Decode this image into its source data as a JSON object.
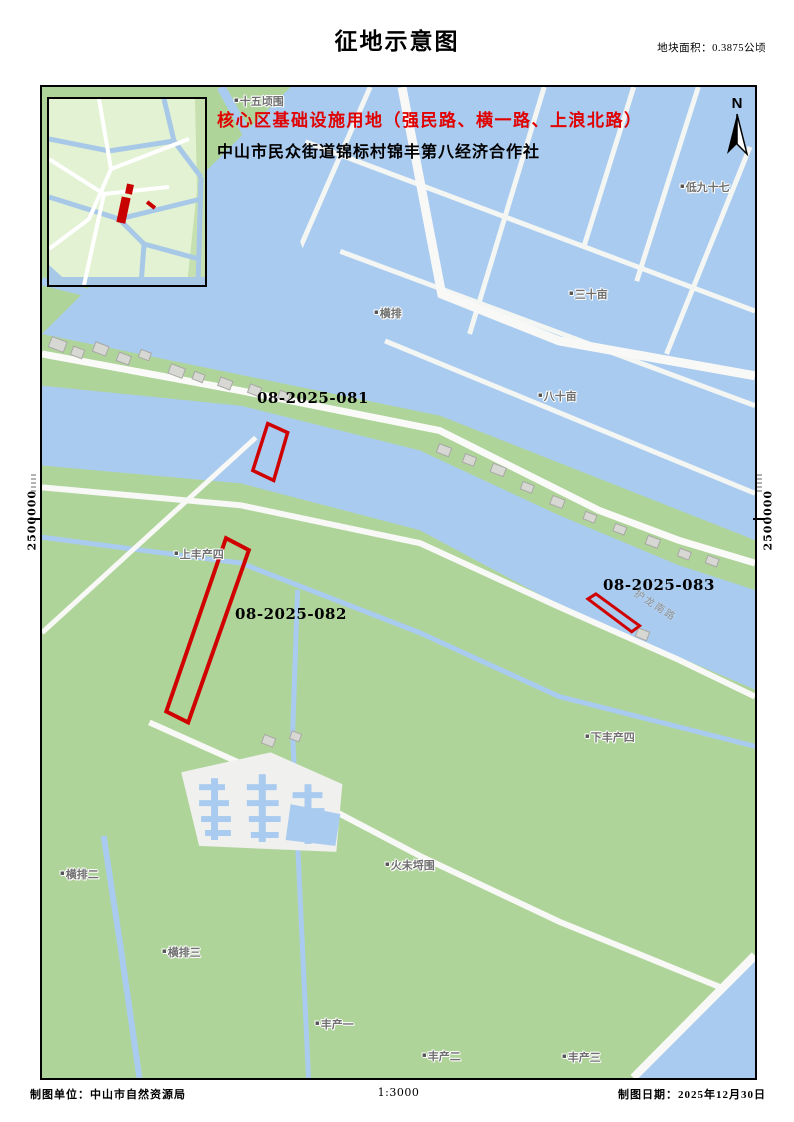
{
  "title": "征地示意图",
  "area_note": "地块面积：0.3875公顷",
  "header": {
    "line1": "核心区基础设施用地（强民路、横一路、上浪北路）",
    "line2": "中山市民众街道锦标村锦丰第八经济合作社"
  },
  "north": {
    "label": "N"
  },
  "axis": {
    "left": "2500000",
    "right": "2500000"
  },
  "parcels": [
    {
      "id": "08-2025-081"
    },
    {
      "id": "08-2025-082"
    },
    {
      "id": "08-2025-083"
    }
  ],
  "map": {
    "marker_glyph": "▪",
    "labels": [
      {
        "text": "十五顷围"
      },
      {
        "text": "横排"
      },
      {
        "text": "三十亩"
      },
      {
        "text": "八十亩"
      },
      {
        "text": "低九十七"
      },
      {
        "text": "上丰产四"
      },
      {
        "text": "下丰产四"
      },
      {
        "text": "火未埒围"
      },
      {
        "text": "横排二"
      },
      {
        "text": "横排三"
      },
      {
        "text": "丰产一"
      },
      {
        "text": "丰产二"
      },
      {
        "text": "丰产三"
      }
    ],
    "road_label": "护龙南路"
  },
  "footer": {
    "left": "制图单位：中山市自然资源局",
    "scale": "1:3000",
    "right": "制图日期：2025年12月30日"
  },
  "colors": {
    "parcel_outline": "#d00000",
    "header_highlight": "#e00000",
    "land": "#afd49a",
    "water": "#a9cbef",
    "road": "#f8f8f6",
    "building": "#d7d7d3",
    "label_text": "#6f6f6f"
  }
}
